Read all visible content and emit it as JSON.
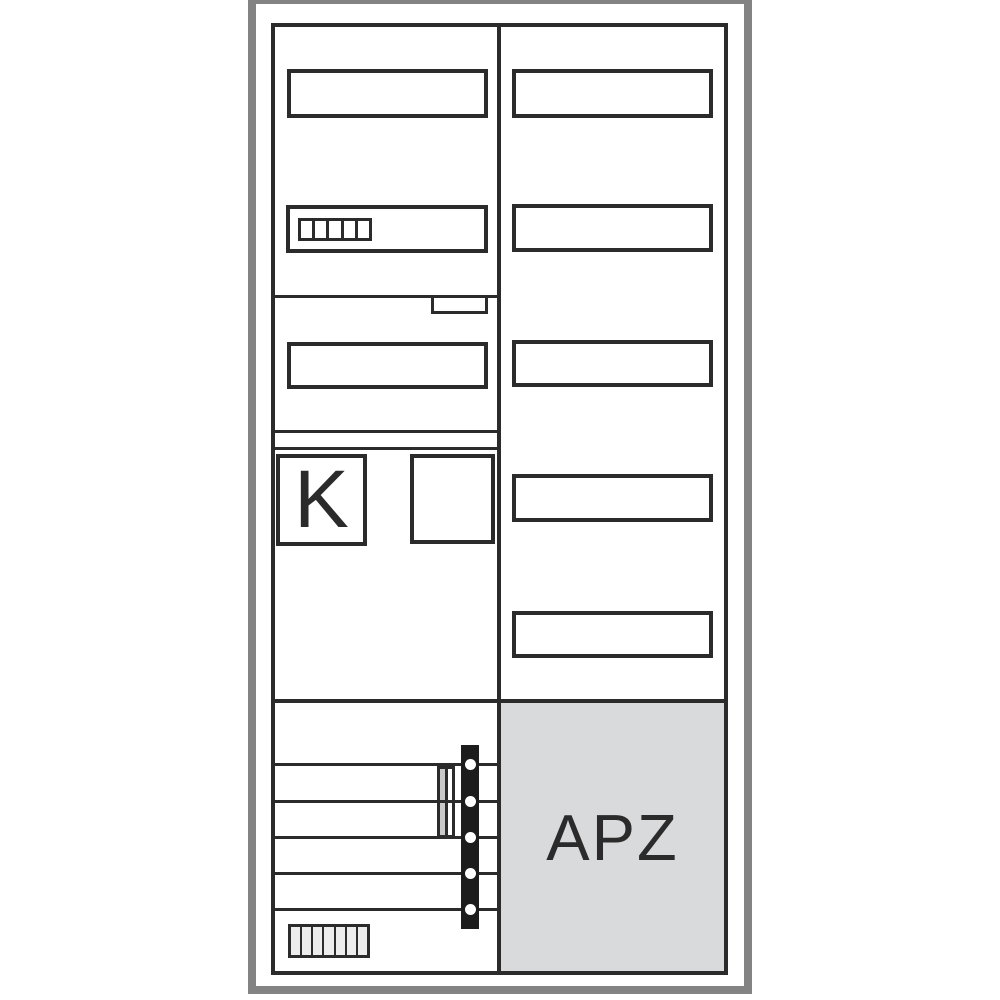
{
  "diagram": {
    "title": "meter-cabinet-line-drawing",
    "labels": {
      "k_field": "K",
      "apz_field": "APZ"
    },
    "colors": {
      "background": "#ffffff",
      "frame_gray": "#838383",
      "line_dark": "#2b2b2b",
      "busbar_fill": "#1c1c1c",
      "apz_fill": "#d9dadc",
      "rail_fill": "#c9c9c9",
      "cell_fill": "#ececec"
    },
    "counts": {
      "top_terminal_cells": 5,
      "bottom_terminal_cells": 7,
      "busbar_dots": 5,
      "right_column_slots": 5,
      "wiring_rows": 5
    }
  }
}
